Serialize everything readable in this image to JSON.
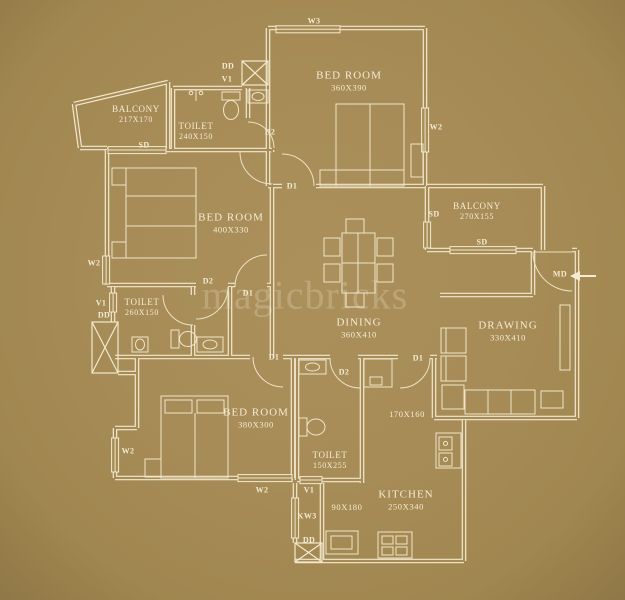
{
  "watermark": "magicbricks",
  "colors": {
    "background": "#a78c57",
    "plan_line": "#f2e9ce",
    "label_text": "#f4ecd2",
    "watermark_text": "rgba(246,238,214,0.24)"
  },
  "rooms": [
    {
      "name": "BALCONY",
      "dims": "217X170"
    },
    {
      "name": "TOILET",
      "dims": "240X150"
    },
    {
      "name": "BED ROOM",
      "dims": "360X390"
    },
    {
      "name": "BALCONY",
      "dims": "270X155"
    },
    {
      "name": "BED ROOM",
      "dims": "400X330"
    },
    {
      "name": "TOILET",
      "dims": "260X150"
    },
    {
      "name": "DINING",
      "dims": "360X410"
    },
    {
      "name": "DRAWING",
      "dims": "330X410"
    },
    {
      "name": "BED ROOM",
      "dims": "380X300"
    },
    {
      "name": "TOILET",
      "dims": "150X255"
    },
    {
      "name": "KITCHEN",
      "dims": "250X340"
    }
  ],
  "passages": [
    {
      "dims": "170X160"
    },
    {
      "dims": "90X180"
    }
  ],
  "markers": [
    {
      "label": "W3"
    },
    {
      "label": "DD"
    },
    {
      "label": "V1"
    },
    {
      "label": "D2"
    },
    {
      "label": "W2"
    },
    {
      "label": "D1"
    },
    {
      "label": "SD"
    },
    {
      "label": "SD"
    },
    {
      "label": "SD"
    },
    {
      "label": "MD"
    },
    {
      "label": "W2"
    },
    {
      "label": "V1"
    },
    {
      "label": "DD"
    },
    {
      "label": "D2"
    },
    {
      "label": "D1"
    },
    {
      "label": "D1"
    },
    {
      "label": "D2"
    },
    {
      "label": "D1"
    },
    {
      "label": "W2"
    },
    {
      "label": "W2"
    },
    {
      "label": "V1"
    },
    {
      "label": "KW3"
    },
    {
      "label": "DD"
    }
  ]
}
